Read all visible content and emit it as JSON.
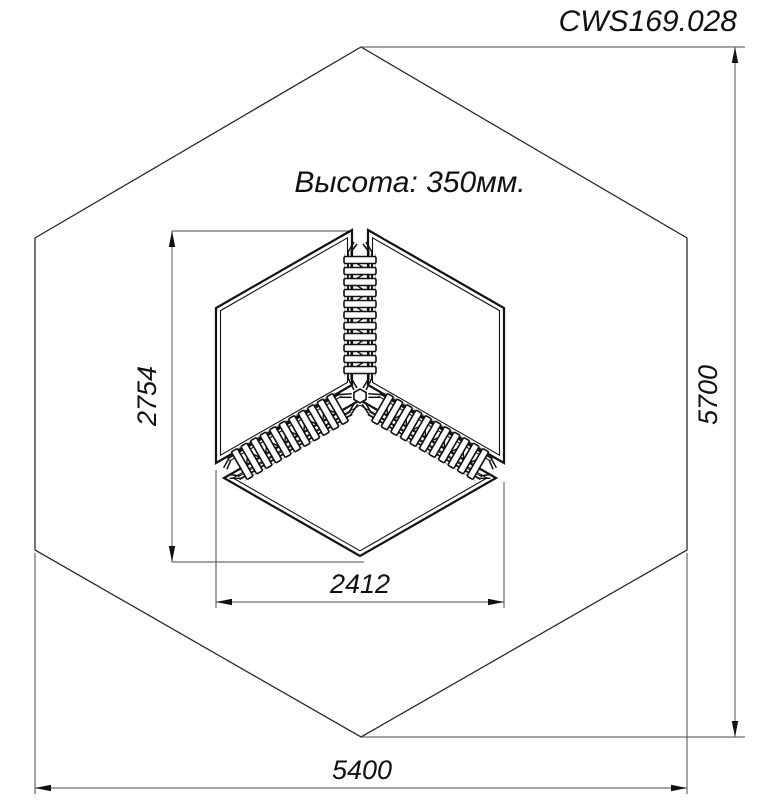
{
  "title": "CWS169.028",
  "note": "Высота: 350мм.",
  "dims": {
    "structure_depth": "2754",
    "structure_width": "2412",
    "site_depth": "5700",
    "site_width": "5400"
  },
  "colors": {
    "line": "#111111",
    "thin": "#2b2b2b",
    "ext": "#4a4a4a",
    "dim": "#707070",
    "bg": "#ffffff"
  }
}
